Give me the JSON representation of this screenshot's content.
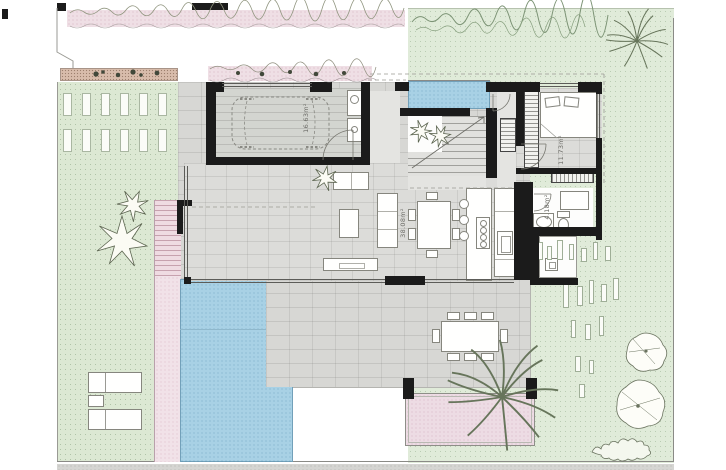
{
  "plan": {
    "title": "villa-ground-floor-site-plan",
    "labels": {
      "garage_area": "16.63m²",
      "living_area": "38.08m²",
      "bedroom_area": "11.73m²",
      "bathroom_area": "4.18m²"
    },
    "colors": {
      "lawn_green": "#dce8d3",
      "garden_green": "#e0ebd9",
      "pool_blue": "#a8d1e5",
      "path_pink": "#f1e2e8",
      "terrace_gray": "#d7d7d4",
      "wall_black": "#1b1b1b"
    }
  }
}
